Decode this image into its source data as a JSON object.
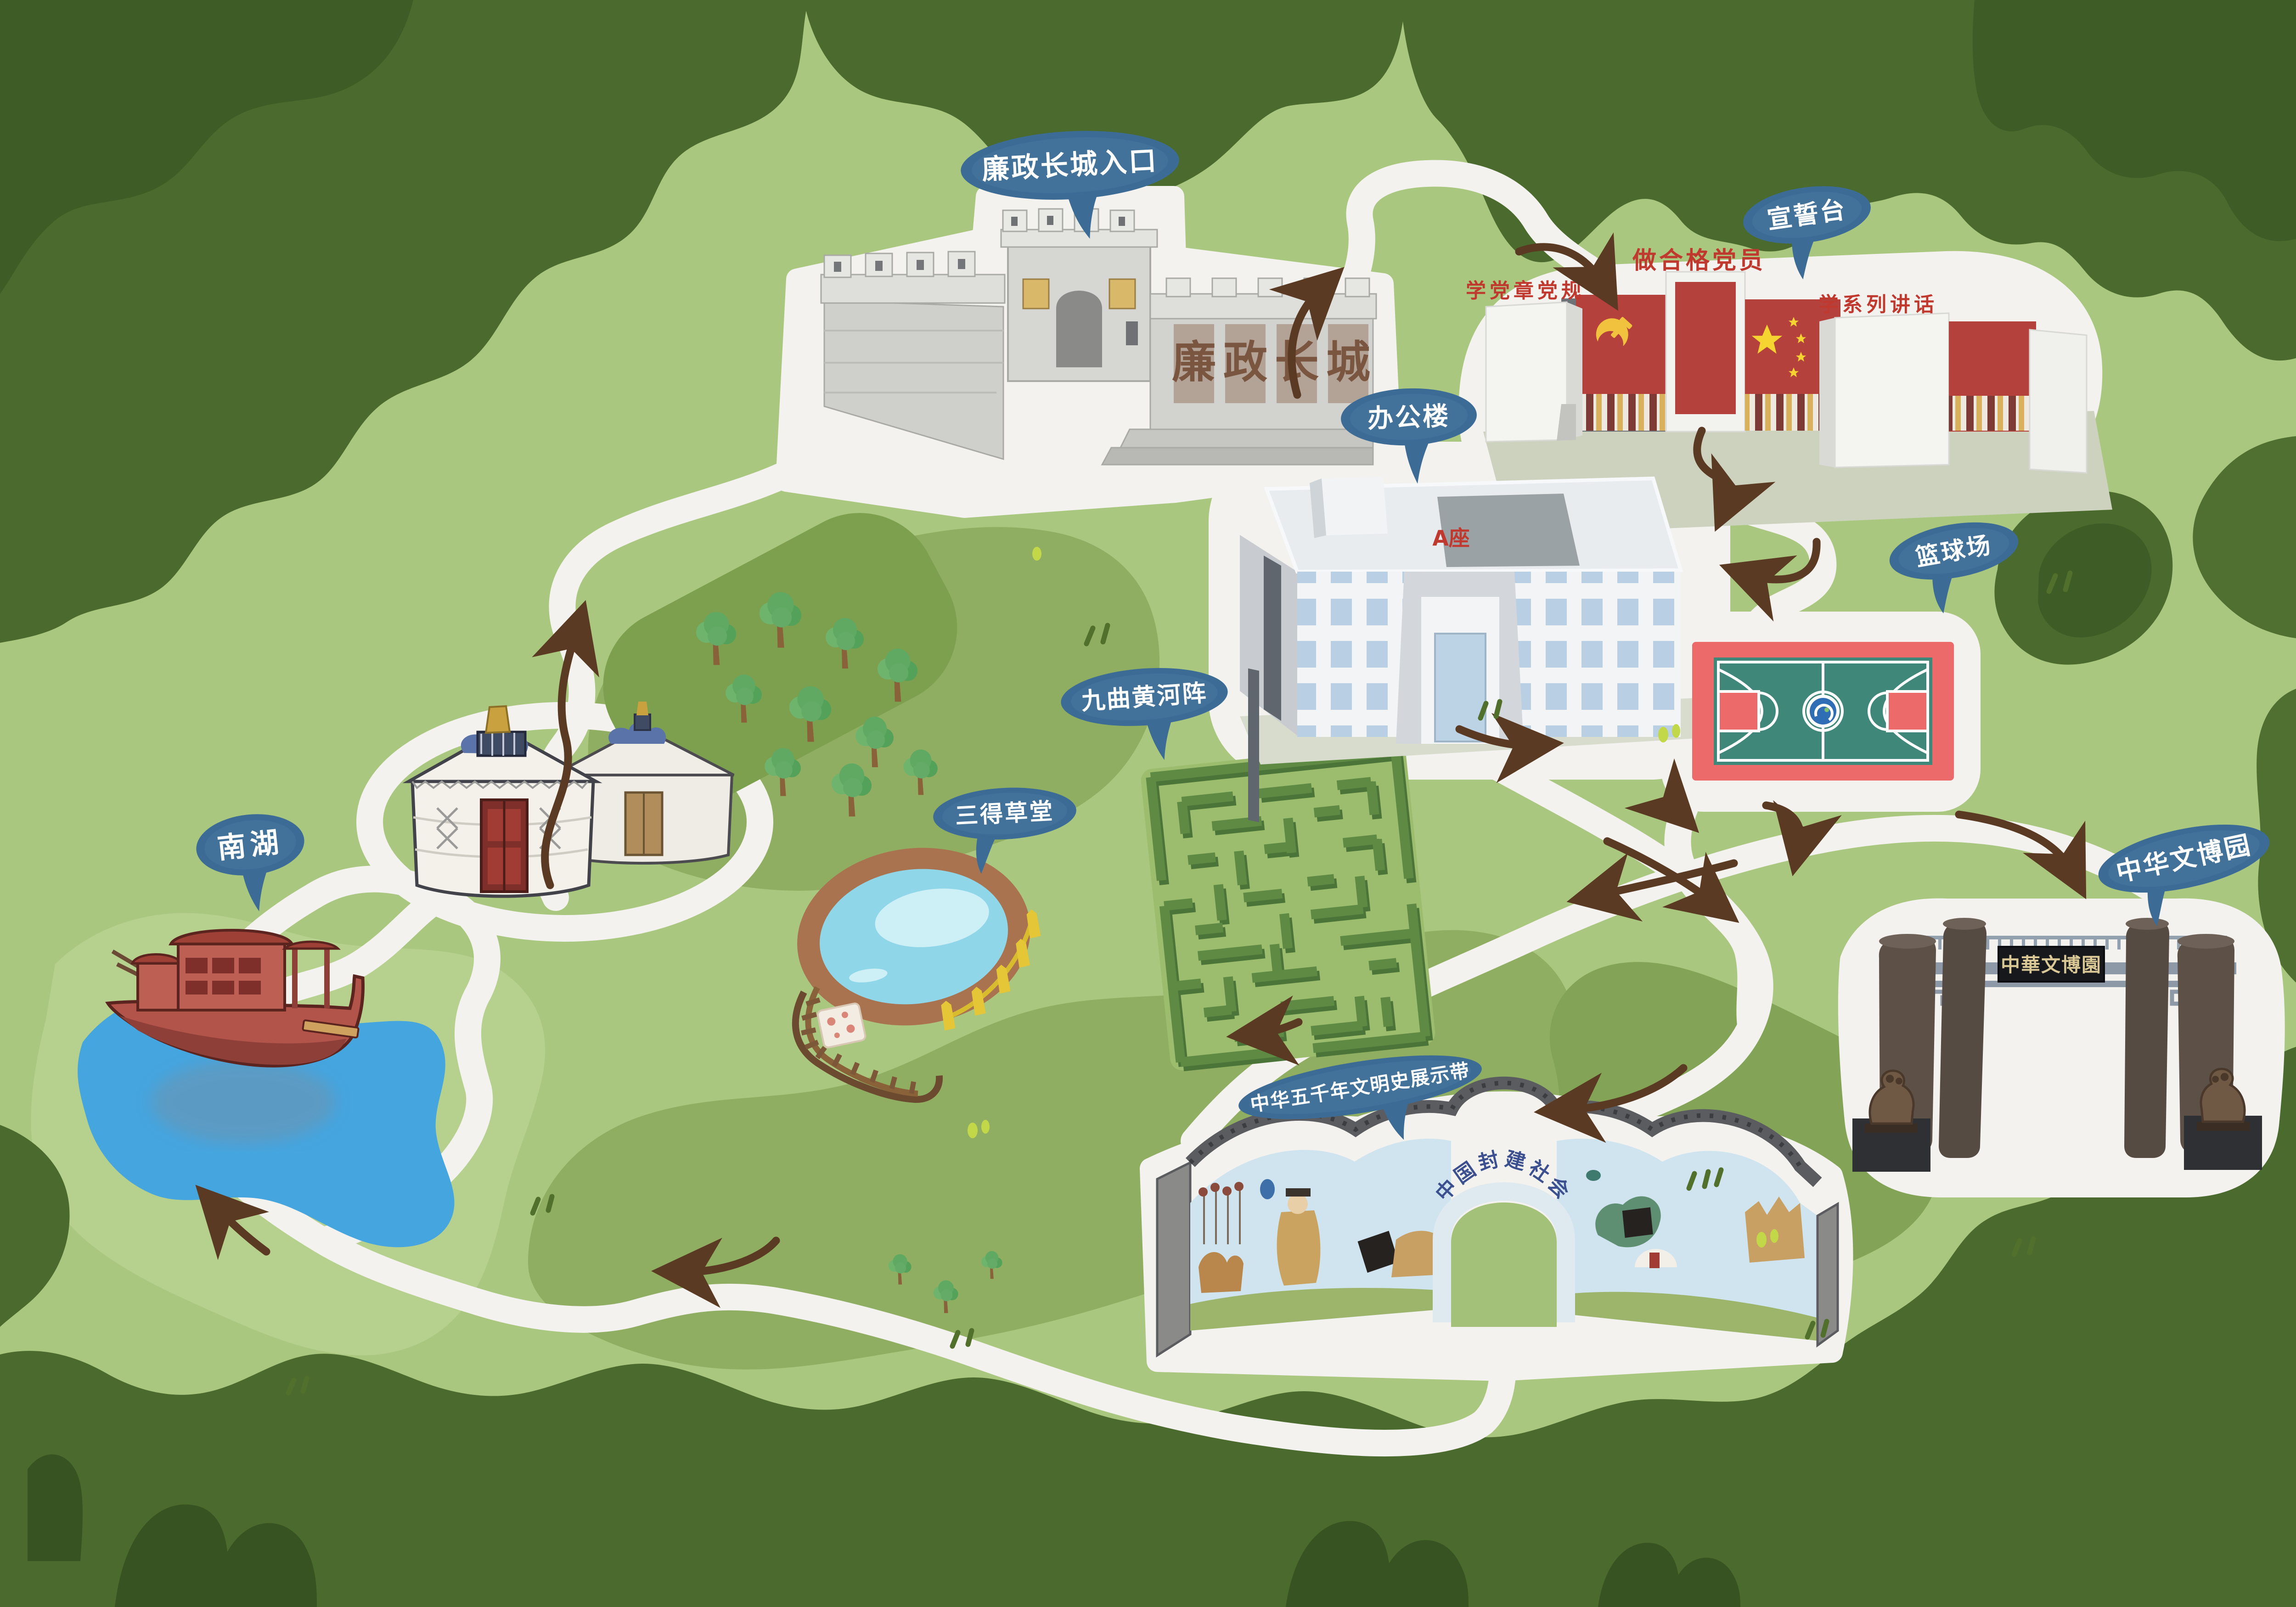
{
  "map_title": "园区手绘导览图",
  "labels": {
    "wall_entrance": "廉政长城入口",
    "oath_stage": "宣誓台",
    "office": "办公楼",
    "basketball": "篮球场",
    "maze": "九曲黄河阵",
    "cottage": "三得草堂",
    "south_lake": "南湖",
    "expo_garden": "中华文博园",
    "civilization_belt": "中华五千年文明史展示带"
  },
  "signs": {
    "wall_chars": [
      "廉",
      "政",
      "长",
      "城"
    ],
    "oath_center": "做合格党员",
    "oath_left": "学党章党规",
    "oath_right": "学系列讲话",
    "office_block": "A座",
    "gate_plaque": "中華文博園",
    "mural_arch": "中国封建社会"
  },
  "colors": {
    "background_green": "#a9c77e",
    "border_tree_green": "#4a6b2d",
    "path_white": "#f3f2ee",
    "arrow_brown": "#5a3a22",
    "label_bubble_blue": "#3c6c95",
    "court_red": "#ed6a6b",
    "court_teal": "#3f8779",
    "lake_blue": "#45a5df",
    "maze_green": "#5e8a44"
  }
}
